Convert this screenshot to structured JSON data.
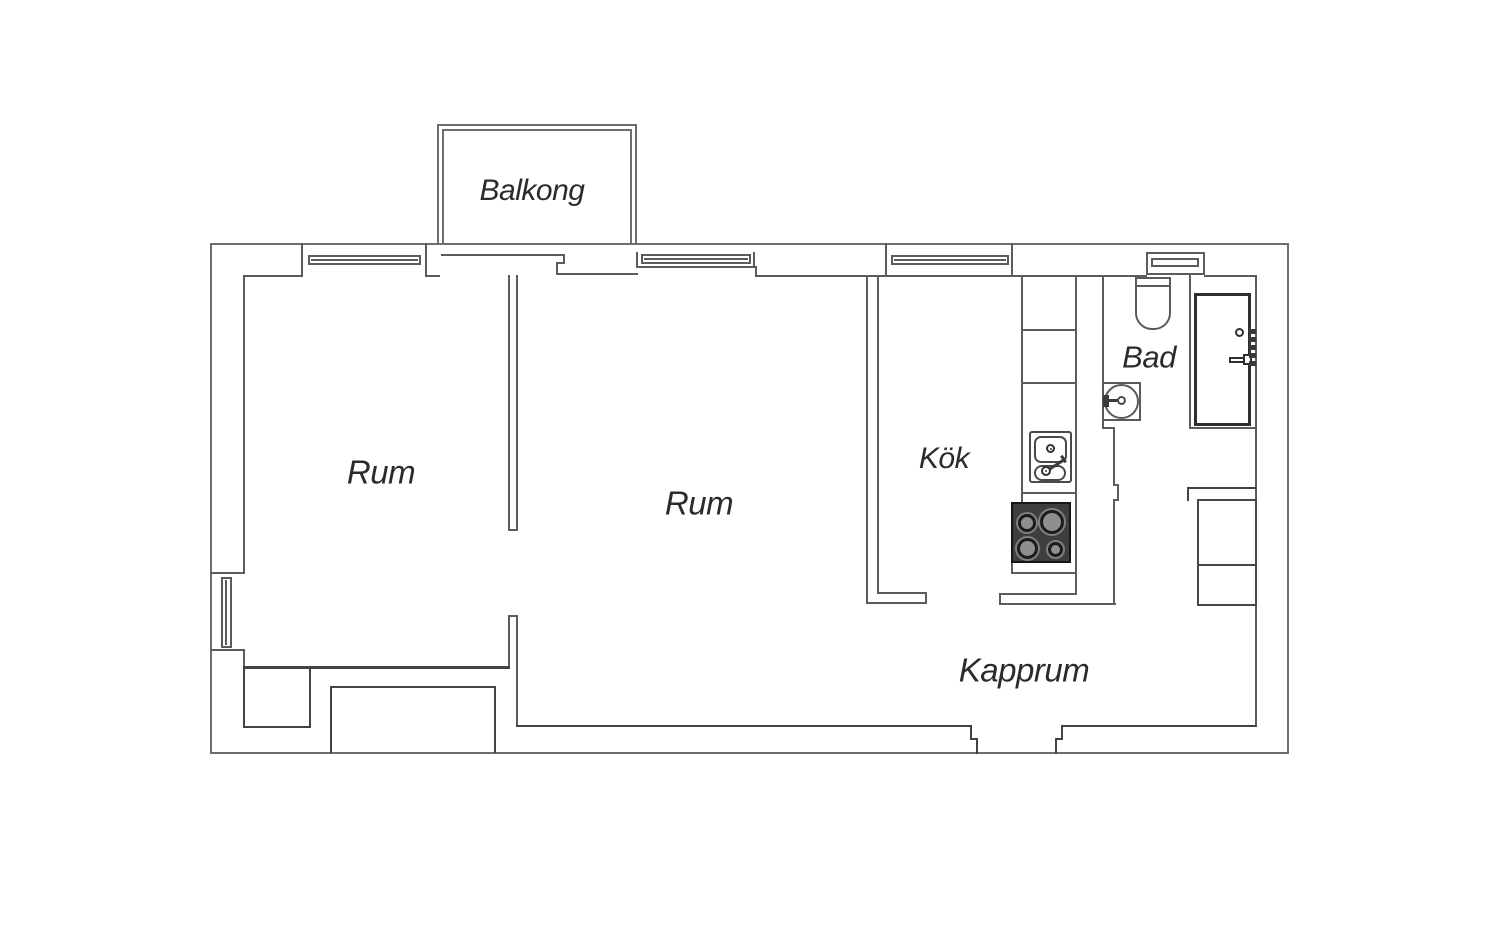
{
  "rooms": {
    "balkong": {
      "label": "Balkong"
    },
    "rum_left": {
      "label": "Rum"
    },
    "rum_middle": {
      "label": "Rum"
    },
    "kok": {
      "label": "Kök"
    },
    "bad": {
      "label": "Bad"
    },
    "kapprum": {
      "label": "Kapprum"
    }
  },
  "fixtures": {
    "toilet": "toilet-icon",
    "washbasin": "washbasin-icon",
    "kitchen_sink": "kitchen-sink-icon",
    "stove": "stove-icon",
    "front_door": "front-door-icon",
    "wardrobe": "wardrobe-icon",
    "window": "window-icon"
  },
  "colors": {
    "background": "#ffffff",
    "exterior_wall": "#6e6e6e",
    "interior_wall": "#5c5c5c",
    "emphasis_wall": "#434343",
    "text": "#2b2b2b",
    "stove_body": "#3e3e3e",
    "burner_disc": "#8f8f8f"
  }
}
